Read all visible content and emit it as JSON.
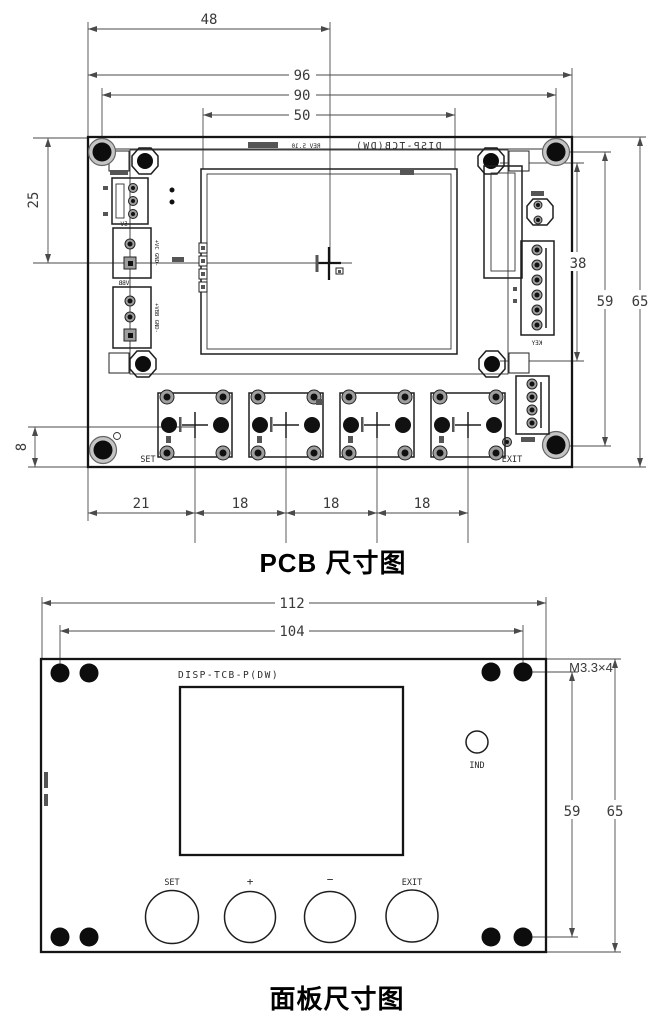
{
  "pcb_drawing": {
    "title": "PCB 尺寸图",
    "silkscreen_model_mirrored": "DISP-TCB(DW)",
    "silkscreen_rev_mirrored": "REV 5.10",
    "dimensions": {
      "top_width_to_center": "48",
      "board_width": "96",
      "hole_span": "90",
      "lcd_width": "50",
      "left_height": "25",
      "button_row_offset": "8",
      "button_pitch_first": "21",
      "button_pitch": [
        "18",
        "18",
        "18"
      ],
      "right_lcd_span": "38",
      "right_hole_span": "59",
      "board_height": "65"
    },
    "labels": {
      "set": "SET",
      "exit": "EXIT",
      "conn_5v": "5V",
      "conn_5v_pins": "+VC GND-",
      "conn_vbb": "VBB",
      "conn_vbb_pins": "+VBB GND-",
      "conn_key_mirrored": "KEY"
    }
  },
  "panel_drawing": {
    "title": "面板尺寸图",
    "model": "DISP-TCB-P(DW)",
    "screw_spec": "M3.3×4",
    "dimensions": {
      "panel_width": "112",
      "hole_span_horizontal": "104",
      "hole_span_vertical": "59",
      "panel_height": "65"
    },
    "buttons": [
      {
        "label": "SET"
      },
      {
        "label": "+"
      },
      {
        "label": "−"
      },
      {
        "label": "EXIT"
      }
    ],
    "indicator_label": "IND"
  }
}
